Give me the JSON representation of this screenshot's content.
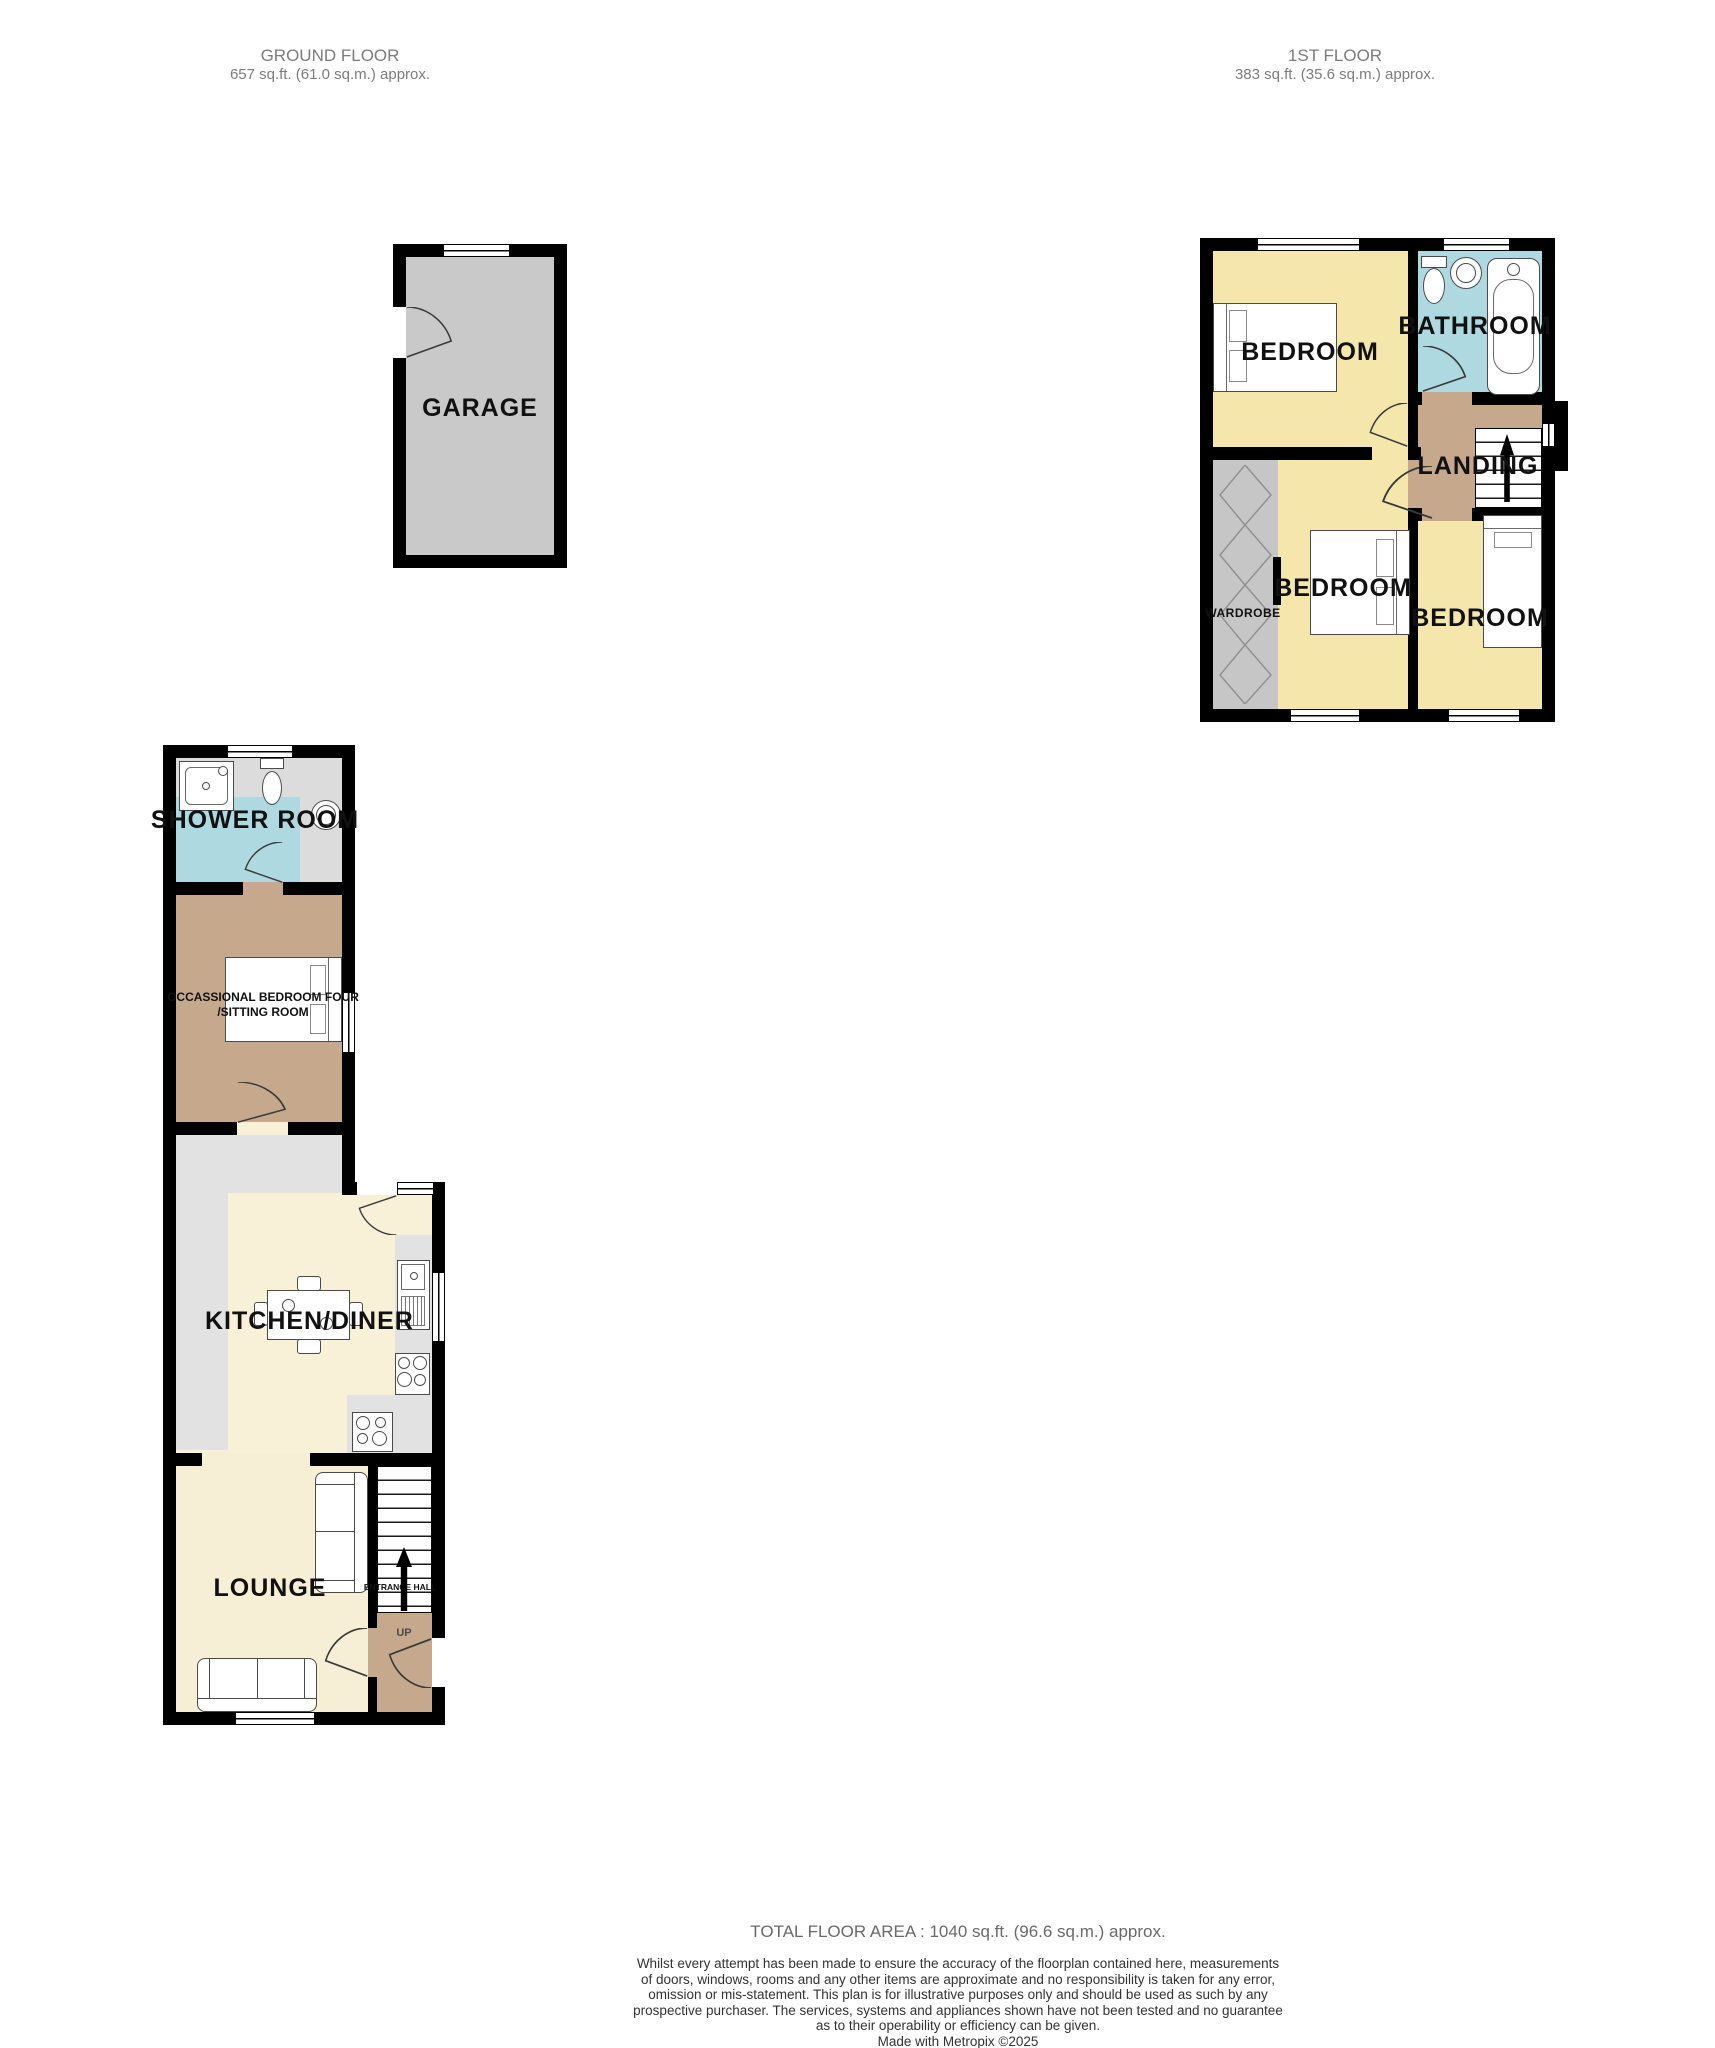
{
  "headers": {
    "ground_floor": {
      "title": "GROUND FLOOR",
      "area": "657 sq.ft. (61.0 sq.m.) approx."
    },
    "first_floor": {
      "title": "1ST FLOOR",
      "area": "383 sq.ft. (35.6 sq.m.) approx."
    }
  },
  "labels": {
    "garage": "GARAGE",
    "bedroom_1": "BEDROOM",
    "bathroom": "BATHROOM",
    "landing": "LANDING",
    "wardrobe": "WARDROBE",
    "bedroom_2": "BEDROOM",
    "bedroom_3": "BEDROOM",
    "shower_room": "SHOWER ROOM",
    "occasional_line1": "OCCASSIONAL BEDROOM FOUR",
    "occasional_line2": "/SITTING ROOM",
    "kitchen_diner": "KITCHEN/DINER",
    "lounge": "LOUNGE",
    "entrance_hall": "ENTRANCE HALL",
    "up": "UP"
  },
  "footer": {
    "total_area": "TOTAL FLOOR AREA : 1040 sq.ft. (96.6 sq.m.) approx.",
    "disclaimer": [
      "Whilst every attempt has been made to ensure the accuracy of the floorplan contained here, measurements",
      "of doors, windows, rooms and any other items are approximate and no responsibility is taken for any error,",
      "omission or mis-statement. This plan is for illustrative purposes only and should be used as such by any",
      "prospective purchaser. The services, systems and appliances shown have not been tested and no guarantee",
      "as to their operability or efficiency can be given."
    ],
    "credit": "Made with Metropix ©2025"
  },
  "colors": {
    "wall": "#000000",
    "bedroom_yellow": "#f5e6ac",
    "bath_blue": "#aed9e0",
    "hall_brown": "#c6a98c",
    "garage_grey": "#c9c9c9",
    "wardrobe_grey": "#c6c6c6",
    "shower_floor_grey": "#dcdcdc",
    "counter_grey": "#e2e2e2",
    "kitchen_cream": "#f8f1d7",
    "lounge_cream": "#f7efd5"
  }
}
